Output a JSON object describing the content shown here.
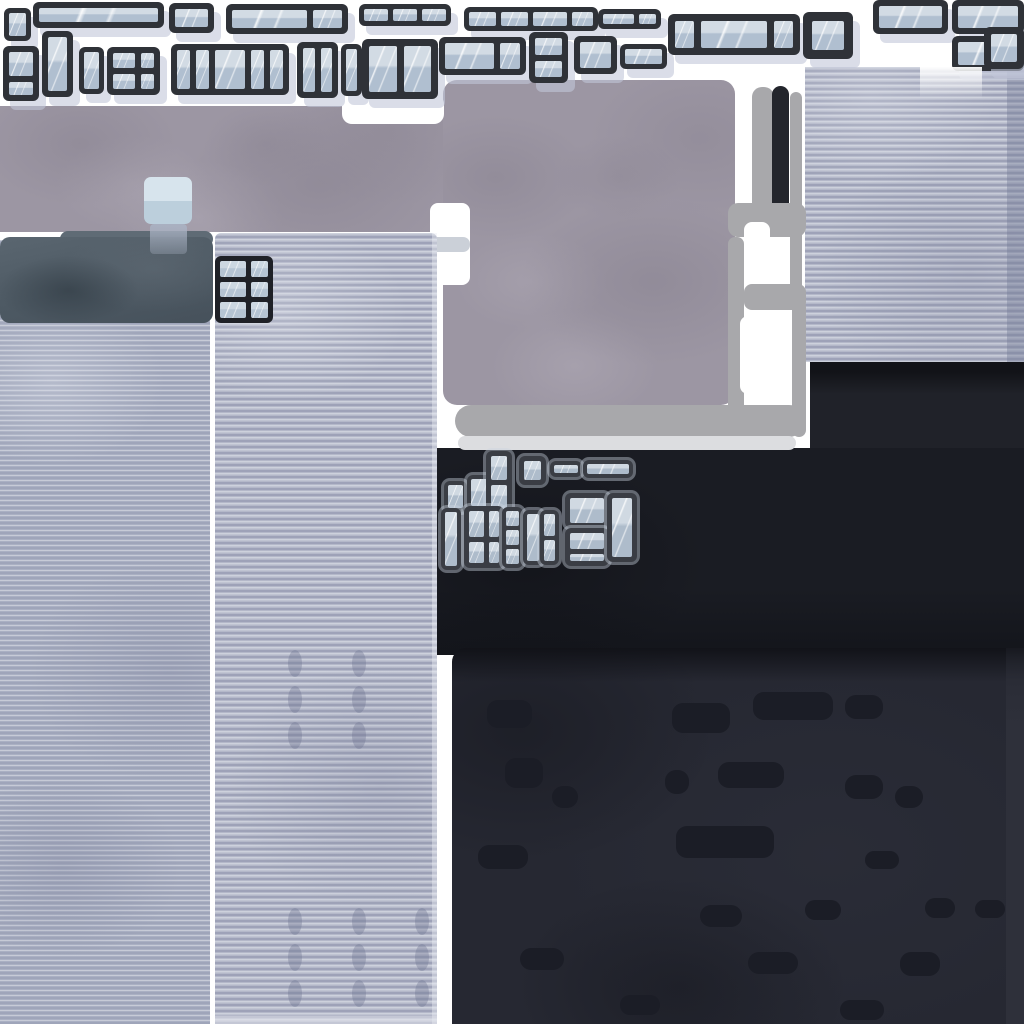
{
  "palette": {
    "white": "#ffffff",
    "concrete": "#9c96a3",
    "concrete_dark": "#837d8b",
    "concrete_light": "#aea8b4",
    "corr1": "#aab0c3",
    "corr2": "#b4b8c9",
    "stripe_dark": "#888da6",
    "stripe_light": "#cdd1dc",
    "header": "#4d5963",
    "header_light": "#5f6b75",
    "frame": "#2f3238",
    "frame_cluster": "#3a3d44",
    "frame_sprite": "#1f2127",
    "glass": "#b0bfd0",
    "glass_light": "#d2dbe4",
    "shadow": "rgba(193,198,217,0.6)",
    "gray": "#a8a8ab",
    "light": "#dcdde0",
    "black_bar": "#23252c",
    "dark1": "#202229",
    "dark2": "#1a1c23",
    "slab": "#262832",
    "dash": "#1b1d26",
    "strip": "#2e303a",
    "cube_top": "#d7e4ed",
    "cube_bottom": "#bccfdc",
    "cube_refl": "#aab3c4"
  },
  "windows": {
    "groups": [
      {
        "name": "window-sprite-top",
        "frame": "#2f3238",
        "glass": "#b0bfd0",
        "glass_light": "#d2dbe4",
        "shadow": true,
        "rim": false,
        "streak": true,
        "items": [
          {
            "x": 4,
            "y": 8,
            "w": 27,
            "h": 33,
            "t": 5
          },
          {
            "x": 33,
            "y": 2,
            "w": 131,
            "h": 26,
            "t": 6
          },
          {
            "x": 169,
            "y": 3,
            "w": 45,
            "h": 30,
            "t": 6
          },
          {
            "x": 226,
            "y": 4,
            "w": 122,
            "h": 30,
            "t": 6,
            "cols": [
              2.6,
              1
            ]
          },
          {
            "x": 359,
            "y": 4,
            "w": 92,
            "h": 22,
            "t": 5,
            "cols": [
              1,
              1,
              1
            ]
          },
          {
            "x": 464,
            "y": 7,
            "w": 134,
            "h": 24,
            "t": 5,
            "cols": [
              1.3,
              1.3,
              1.6,
              1
            ]
          },
          {
            "x": 598,
            "y": 9,
            "w": 63,
            "h": 20,
            "t": 5,
            "cols": [
              1.8,
              1
            ]
          },
          {
            "x": 668,
            "y": 14,
            "w": 132,
            "h": 41,
            "t": 7,
            "cols": [
              1,
              3.4,
              1
            ]
          },
          {
            "x": 803,
            "y": 12,
            "w": 50,
            "h": 47,
            "t": 9
          },
          {
            "x": 873,
            "y": 0,
            "w": 75,
            "h": 34,
            "t": 6
          },
          {
            "x": 952,
            "y": 0,
            "w": 72,
            "h": 34,
            "t": 6
          },
          {
            "x": 952,
            "y": 36,
            "w": 72,
            "h": 35,
            "t": 6
          },
          {
            "x": 3,
            "y": 46,
            "w": 36,
            "h": 55,
            "t": 6,
            "rows": [
              1.8,
              1
            ]
          },
          {
            "x": 42,
            "y": 31,
            "w": 31,
            "h": 66,
            "t": 6
          },
          {
            "x": 79,
            "y": 47,
            "w": 25,
            "h": 47,
            "t": 5
          },
          {
            "x": 107,
            "y": 47,
            "w": 53,
            "h": 48,
            "t": 6,
            "cols": [
              1.6,
              1
            ],
            "rows": [
              1,
              1
            ]
          },
          {
            "x": 171,
            "y": 44,
            "w": 118,
            "h": 51,
            "t": 6,
            "cols": [
              1,
              1,
              2.4,
              1,
              1
            ]
          },
          {
            "x": 297,
            "y": 42,
            "w": 41,
            "h": 56,
            "t": 6,
            "cols": [
              1,
              1
            ]
          },
          {
            "x": 341,
            "y": 44,
            "w": 21,
            "h": 52,
            "t": 5
          },
          {
            "x": 362,
            "y": 39,
            "w": 76,
            "h": 60,
            "t": 7,
            "cols": [
              1,
              1
            ]
          },
          {
            "x": 439,
            "y": 37,
            "w": 87,
            "h": 38,
            "t": 6,
            "cols": [
              2.4,
              1
            ]
          },
          {
            "x": 529,
            "y": 32,
            "w": 39,
            "h": 51,
            "t": 6,
            "rows": [
              1.1,
              1
            ]
          },
          {
            "x": 574,
            "y": 36,
            "w": 43,
            "h": 38,
            "t": 6
          },
          {
            "x": 620,
            "y": 44,
            "w": 47,
            "h": 25,
            "t": 5
          },
          {
            "x": 984,
            "y": 27,
            "w": 40,
            "h": 42,
            "t": 7
          }
        ]
      },
      {
        "name": "window-sprite-small",
        "frame": "#3a3d44",
        "glass": "#aebccb",
        "glass_light": "#d0d9e2",
        "shadow": false,
        "rim": true,
        "streak": true,
        "items": [
          {
            "x": 444,
            "y": 481,
            "w": 23,
            "h": 31,
            "t": 4
          },
          {
            "x": 467,
            "y": 475,
            "w": 26,
            "h": 35,
            "t": 4
          },
          {
            "x": 486,
            "y": 451,
            "w": 26,
            "h": 63,
            "t": 5,
            "rows": [
              1,
              1
            ]
          },
          {
            "x": 519,
            "y": 456,
            "w": 27,
            "h": 29,
            "t": 5
          },
          {
            "x": 550,
            "y": 461,
            "w": 32,
            "h": 16,
            "t": 4
          },
          {
            "x": 583,
            "y": 460,
            "w": 50,
            "h": 18,
            "t": 4
          },
          {
            "x": 441,
            "y": 508,
            "w": 20,
            "h": 62,
            "t": 4
          },
          {
            "x": 464,
            "y": 506,
            "w": 40,
            "h": 62,
            "t": 5,
            "cols": [
              1.5,
              1
            ],
            "rows": [
              1.2,
              1
            ]
          },
          {
            "x": 502,
            "y": 507,
            "w": 21,
            "h": 61,
            "t": 4,
            "rows": [
              1,
              1,
              1
            ]
          },
          {
            "x": 523,
            "y": 510,
            "w": 20,
            "h": 55,
            "t": 4
          },
          {
            "x": 540,
            "y": 510,
            "w": 19,
            "h": 55,
            "t": 4,
            "rows": [
              1,
              1
            ]
          },
          {
            "x": 565,
            "y": 493,
            "w": 44,
            "h": 35,
            "t": 5
          },
          {
            "x": 565,
            "y": 528,
            "w": 44,
            "h": 38,
            "t": 5,
            "rows": [
              2.2,
              1
            ]
          },
          {
            "x": 607,
            "y": 493,
            "w": 30,
            "h": 69,
            "t": 5
          }
        ]
      },
      {
        "name": "window-sprite-wall",
        "frame": "#1f2127",
        "glass": "#b5c4d3",
        "glass_light": "#ccd7e1",
        "shadow": false,
        "rim": false,
        "streak": true,
        "items": [
          {
            "x": 215,
            "y": 256,
            "w": 58,
            "h": 67,
            "t": 5,
            "cols": [
              1.5,
              1
            ],
            "rows": [
              1,
              1,
              1
            ]
          }
        ]
      }
    ]
  },
  "markings": [
    {
      "name": "pipe-bar",
      "x": 752,
      "y": 87,
      "w": 22,
      "h": 150,
      "r": 10,
      "color": "gray"
    },
    {
      "name": "door-bar",
      "x": 772,
      "y": 86,
      "w": 17,
      "h": 128,
      "r": 9,
      "color": "black_bar"
    },
    {
      "name": "pipe-bar",
      "x": 790,
      "y": 92,
      "w": 12,
      "h": 212,
      "r": 6,
      "color": "gray"
    },
    {
      "name": "frame-bar",
      "x": 728,
      "y": 203,
      "w": 78,
      "h": 34,
      "r": 10,
      "color": "gray"
    },
    {
      "name": "frame-hole",
      "x": 744,
      "y": 222,
      "w": 26,
      "h": 62,
      "r": 8,
      "color": "white"
    },
    {
      "name": "frame-bar",
      "x": 728,
      "y": 237,
      "w": 16,
      "h": 200,
      "r": 7,
      "color": "gray"
    },
    {
      "name": "frame-bar",
      "x": 744,
      "y": 284,
      "w": 62,
      "h": 26,
      "r": 8,
      "color": "gray"
    },
    {
      "name": "frame-bar",
      "x": 792,
      "y": 300,
      "w": 14,
      "h": 137,
      "r": 7,
      "color": "gray"
    },
    {
      "name": "frame-hole",
      "x": 740,
      "y": 316,
      "w": 48,
      "h": 78,
      "r": 8,
      "color": "white"
    },
    {
      "name": "curb-bar",
      "x": 455,
      "y": 405,
      "w": 350,
      "h": 32,
      "r": 16,
      "color": "gray"
    },
    {
      "name": "curb-bar-light",
      "x": 458,
      "y": 436,
      "w": 338,
      "h": 14,
      "r": 7,
      "color": "light"
    }
  ],
  "dashes": [
    [
      487,
      700,
      45,
      28
    ],
    [
      672,
      703,
      58,
      30
    ],
    [
      753,
      692,
      80,
      28
    ],
    [
      845,
      695,
      38,
      24
    ],
    [
      505,
      758,
      38,
      30
    ],
    [
      665,
      770,
      24,
      24
    ],
    [
      718,
      762,
      66,
      26
    ],
    [
      845,
      775,
      38,
      24
    ],
    [
      895,
      786,
      28,
      22
    ],
    [
      552,
      786,
      26,
      22
    ],
    [
      676,
      826,
      98,
      32
    ],
    [
      478,
      845,
      50,
      24
    ],
    [
      865,
      851,
      34,
      18
    ],
    [
      700,
      905,
      42,
      22
    ],
    [
      805,
      900,
      36,
      20
    ],
    [
      925,
      898,
      30,
      20
    ],
    [
      975,
      900,
      30,
      18
    ],
    [
      520,
      948,
      44,
      22
    ],
    [
      748,
      952,
      50,
      22
    ],
    [
      900,
      952,
      40,
      24
    ],
    [
      620,
      995,
      40,
      20
    ],
    [
      840,
      1000,
      44,
      20
    ]
  ],
  "studs": [
    [
      288,
      650
    ],
    [
      352,
      650
    ],
    [
      288,
      686
    ],
    [
      352,
      686
    ],
    [
      288,
      722
    ],
    [
      352,
      722
    ],
    [
      288,
      908
    ],
    [
      352,
      908
    ],
    [
      288,
      944
    ],
    [
      352,
      944
    ],
    [
      288,
      980
    ],
    [
      352,
      980
    ],
    [
      415,
      908
    ],
    [
      415,
      944
    ],
    [
      415,
      980
    ]
  ]
}
